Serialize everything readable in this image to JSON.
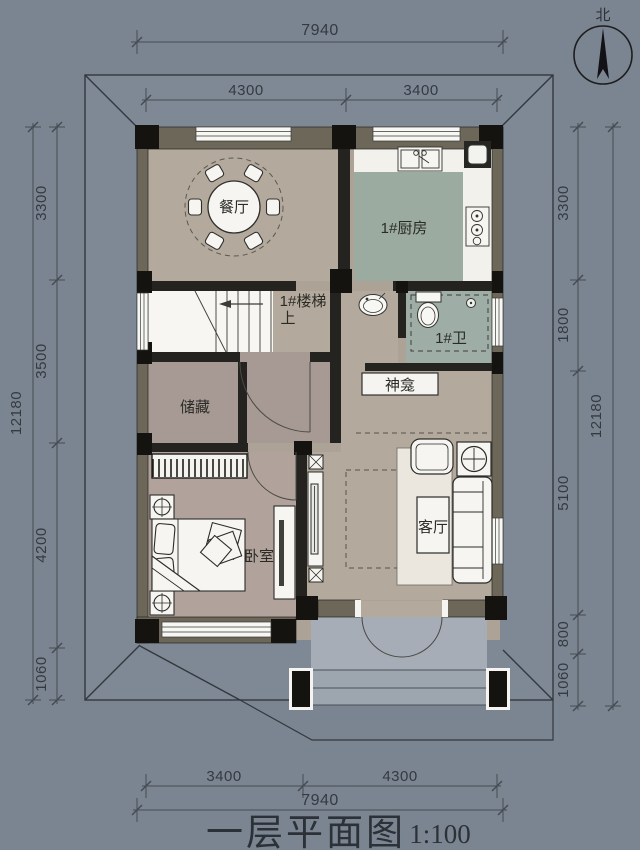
{
  "page": {
    "type": "architectural-floor-plan"
  },
  "title": {
    "text": "一层平面图",
    "scale": "1:100"
  },
  "compass": {
    "label": "北"
  },
  "rooms": {
    "dining": "餐厅",
    "kitchen": "1#厨房",
    "stairs": "1#楼梯",
    "stairs_direction": "上",
    "bathroom": "1#卫",
    "shrine": "神龛",
    "storage": "储藏",
    "living": "客厅",
    "bedroom": "卧室"
  },
  "dimensions": {
    "top": {
      "overall": "7940",
      "segments": [
        "4300",
        "3400"
      ]
    },
    "bottom": {
      "overall": "7940",
      "segments": [
        "3400",
        "4300"
      ]
    },
    "left": {
      "overall": "12180",
      "segments": [
        "3300",
        "3500",
        "4200",
        "1060"
      ]
    },
    "right": {
      "overall": "12180",
      "segments": [
        "3300",
        "1800",
        "5100",
        "800",
        "1060"
      ]
    }
  },
  "colors": {
    "background": "#7b8591",
    "roof": "#7f8995",
    "floor_tan": "#b3a99c",
    "floor_kitchen": "#9bab9f",
    "floor_bath": "#9fada7",
    "floor_storage": "#a79a94",
    "floor_bedroom": "#b1a29c",
    "floor_porch": "#a6adb6",
    "wall_olive": "#6d6759",
    "wall_dark": "#24231f",
    "column_black": "#141310",
    "dim_line": "#454b54",
    "fixture_white": "#f6f5f1"
  }
}
